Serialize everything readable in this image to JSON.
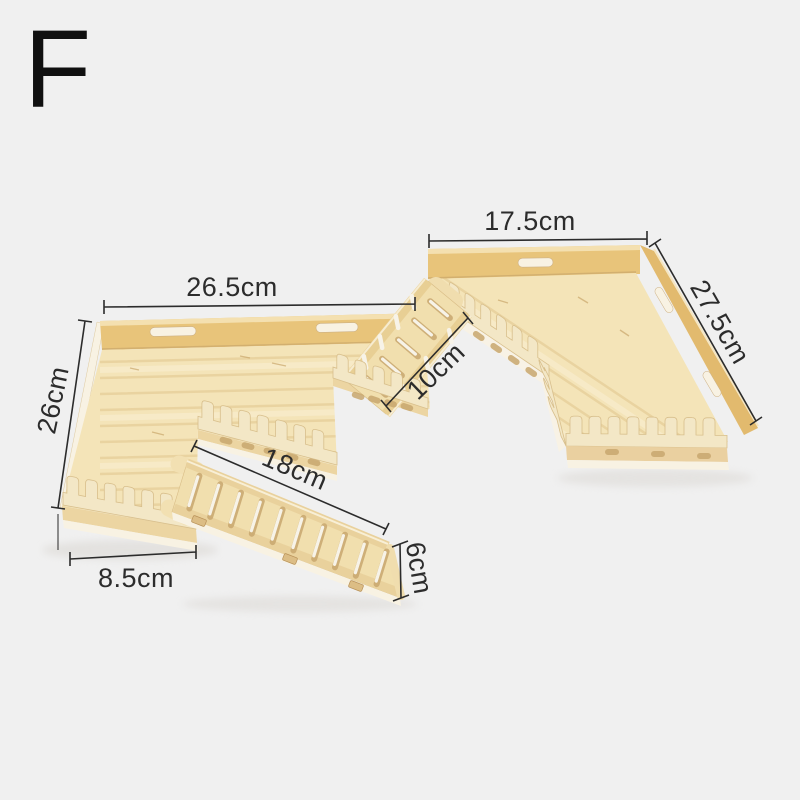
{
  "product": {
    "variant_label": "F"
  },
  "dimensions": {
    "top_width": {
      "label": "17.5cm",
      "value": 17.5,
      "unit": "cm"
    },
    "right_depth": {
      "label": "27.5cm",
      "value": 27.5,
      "unit": "cm"
    },
    "left_width": {
      "label": "26.5cm",
      "value": 26.5,
      "unit": "cm"
    },
    "left_depth": {
      "label": "26cm",
      "value": 26,
      "unit": "cm"
    },
    "bridge_length": {
      "label": "10cm",
      "value": 10,
      "unit": "cm"
    },
    "ramp_length": {
      "label": "18cm",
      "value": 18,
      "unit": "cm"
    },
    "front_shelf_width": {
      "label": "8.5cm",
      "value": 8.5,
      "unit": "cm"
    },
    "ramp_height": {
      "label": "6cm",
      "value": 6,
      "unit": "cm"
    }
  },
  "colors": {
    "background": "#f0f0f0",
    "wood_face": "#e8c47a",
    "wood_face_dark": "#e2ba6e",
    "wood_surface": "#f4e4b8",
    "wood_light": "#f1dfae",
    "wood_cream": "#f3e7c6",
    "wood_base": "#ecd5a2",
    "wood_edge_white": "#f8f2e3",
    "fence_outline": "#d8bf8c",
    "grain_dark": "#e0c48c",
    "grain_light": "#f9efd5",
    "seam": "#c9a76b",
    "slot_dark": "#c8a76e",
    "slot_light": "#f7f3e8",
    "shadow": "#d9d6d1",
    "annotation_ink": "#2c2c2c",
    "letter_ink": "#101010"
  }
}
